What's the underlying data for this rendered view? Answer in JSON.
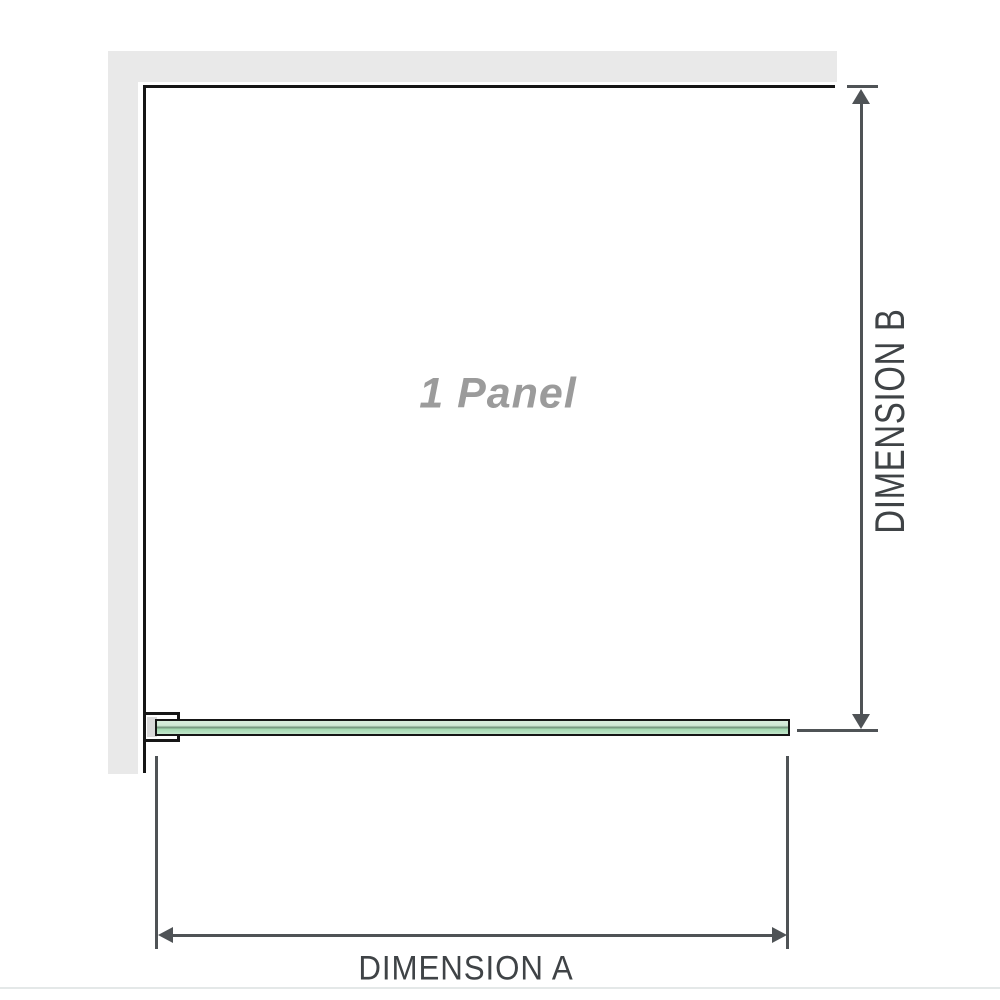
{
  "diagram": {
    "panel_label": "1 Panel",
    "dimension_a_label": "DIMENSION A",
    "dimension_b_label": "DIMENSION B",
    "colors": {
      "wall": "#e9e9e9",
      "outline": "#161616",
      "dimension_line": "#4f5356",
      "label_text": "#3f4346",
      "panel_label_gray": "#9b9b9b",
      "glass_green": "#a4d8b1",
      "glass_green_light": "#d8ecdc",
      "glass_green_dark": "#6e8f77",
      "bracket_insert": "#d9d9d9",
      "divider": "#e4e8e8"
    }
  }
}
